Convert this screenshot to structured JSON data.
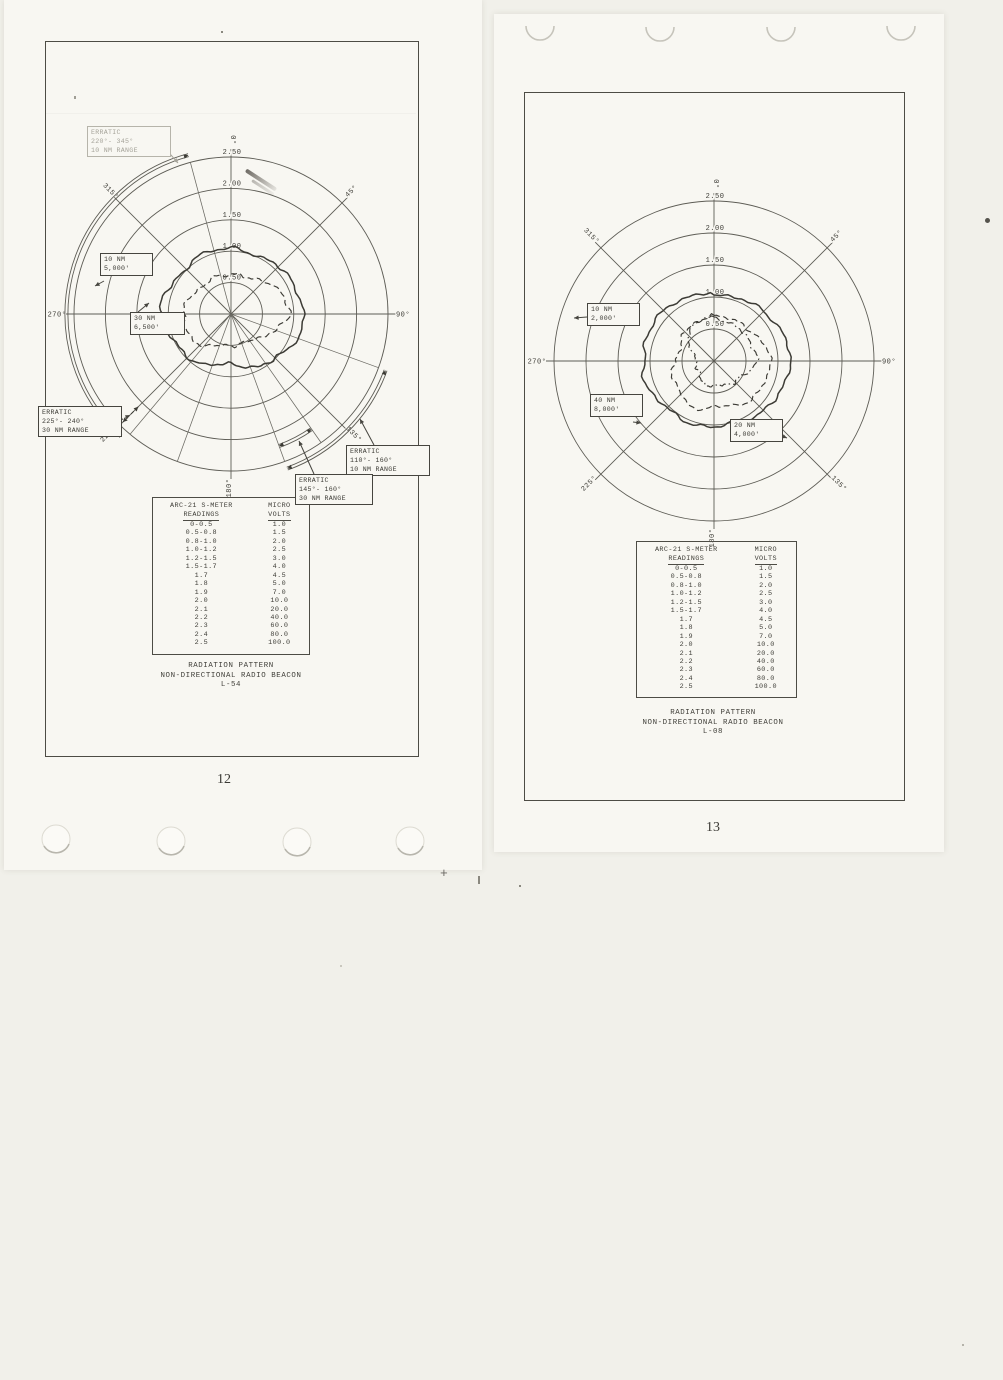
{
  "scan": {
    "backdrop_color": "#f1f0ea",
    "sheet_color": "#f8f7f2",
    "grid_color": "#5d5c55",
    "ink_color": "#3c3b35",
    "faded_color": "#a5a399"
  },
  "pages": [
    {
      "number": "12",
      "caption_lines": [
        "RADIATION PATTERN",
        "NON-DIRECTIONAL RADIO BEACON",
        "L-54"
      ]
    },
    {
      "number": "13",
      "caption_lines": [
        "RADIATION PATTERN",
        "NON-DIRECTIONAL RADIO BEACON",
        "L-08"
      ]
    }
  ],
  "smeter_table": {
    "col1_header": [
      "ARC-21 S-METER",
      "READINGS"
    ],
    "col2_header": [
      "MICRO",
      "VOLTS"
    ],
    "rows": [
      [
        "0-0.5",
        "1.0"
      ],
      [
        "0.5-0.8",
        "1.5"
      ],
      [
        "0.8-1.0",
        "2.0"
      ],
      [
        "1.0-1.2",
        "2.5"
      ],
      [
        "1.2-1.5",
        "3.0"
      ],
      [
        "1.5-1.7",
        "4.0"
      ],
      [
        "1.7",
        "4.5"
      ],
      [
        "1.8",
        "5.0"
      ],
      [
        "1.9",
        "7.0"
      ],
      [
        "2.0",
        "10.0"
      ],
      [
        "2.1",
        "20.0"
      ],
      [
        "2.2",
        "40.0"
      ],
      [
        "2.3",
        "60.0"
      ],
      [
        "2.4",
        "80.0"
      ],
      [
        "2.5",
        "100.0"
      ]
    ]
  },
  "chart_data": [
    {
      "type": "polar-radiation-pattern",
      "title": "RADIATION PATTERN NON-DIRECTIONAL RADIO BEACON L-54",
      "ring_labels": [
        "0.50",
        "1.00",
        "1.50",
        "2.00",
        "2.50"
      ],
      "angle_labels_deg": [
        0,
        45,
        90,
        135,
        180,
        225,
        270,
        315
      ],
      "extra_radials_deg": [
        110,
        145,
        160,
        200,
        220,
        345
      ],
      "layout": {
        "cx": 186,
        "cy": 273,
        "unit": 31.4,
        "rings": 5
      },
      "sectors": [
        {
          "from": 222,
          "to": 345,
          "r_px": 163
        },
        {
          "from": 110,
          "to": 160,
          "r_px": 163
        },
        {
          "from": 145,
          "to": 160,
          "r_px": 139
        }
      ],
      "radial_arrows": [
        {
          "deg": 225,
          "r1_px": 131,
          "r2_px": 153
        }
      ],
      "series": [
        {
          "name": "10 NM at 5,000 ft",
          "style": "solid",
          "seed": 3,
          "points": [
            [
              0,
              2.12
            ],
            [
              15,
              2.08
            ],
            [
              30,
              2.04
            ],
            [
              45,
              2.1
            ],
            [
              60,
              2.2
            ],
            [
              75,
              2.28
            ],
            [
              90,
              2.3
            ],
            [
              105,
              2.26
            ],
            [
              120,
              2.18
            ],
            [
              135,
              2.02
            ],
            [
              150,
              1.88
            ],
            [
              165,
              1.7
            ],
            [
              180,
              1.62
            ],
            [
              195,
              1.68
            ],
            [
              210,
              1.8
            ],
            [
              225,
              1.92
            ],
            [
              240,
              2.02
            ],
            [
              255,
              2.1
            ],
            [
              270,
              2.16
            ],
            [
              285,
              2.24
            ],
            [
              300,
              2.12
            ],
            [
              315,
              2.02
            ],
            [
              330,
              2.06
            ],
            [
              345,
              2.12
            ]
          ]
        },
        {
          "name": "30 NM at 6,500 ft",
          "style": "dashed",
          "seed": 8,
          "points": [
            [
              0,
              1.22
            ],
            [
              15,
              1.28
            ],
            [
              30,
              1.35
            ],
            [
              45,
              1.45
            ],
            [
              60,
              1.62
            ],
            [
              75,
              1.82
            ],
            [
              90,
              1.93
            ],
            [
              105,
              1.55
            ],
            [
              120,
              1.28
            ],
            [
              135,
              1.18
            ],
            [
              150,
              1.02
            ],
            [
              165,
              0.95
            ],
            [
              180,
              1.0
            ],
            [
              195,
              1.06
            ],
            [
              210,
              1.18
            ],
            [
              225,
              1.34
            ],
            [
              240,
              1.48
            ],
            [
              255,
              1.55
            ],
            [
              270,
              1.5
            ],
            [
              285,
              1.43
            ],
            [
              300,
              1.35
            ],
            [
              315,
              1.3
            ],
            [
              330,
              1.27
            ],
            [
              345,
              1.23
            ]
          ]
        }
      ],
      "callouts": [
        {
          "x": 87,
          "y": 126,
          "w": 76,
          "lines": [
            "ERRATIC",
            "220°- 345°",
            "10 NM RANGE"
          ],
          "anchor": [
            163,
            146
          ],
          "target": [
            178,
            163
          ],
          "faded": true
        },
        {
          "x": 100,
          "y": 253,
          "w": 45,
          "lines": [
            "10 NM",
            "5,000'"
          ],
          "anchor": [
            104,
            281
          ],
          "target": [
            95,
            286
          ]
        },
        {
          "x": 130,
          "y": 312,
          "w": 47,
          "lines": [
            "30 NM",
            "6,500'"
          ],
          "anchor": [
            138,
            312
          ],
          "target": [
            149,
            303
          ]
        },
        {
          "x": 38,
          "y": 406,
          "w": 76,
          "lines": [
            "ERRATIC",
            "225°- 240°",
            "30 NM RANGE"
          ],
          "anchor": [
            114,
            424
          ],
          "target": [
            130,
            415
          ],
          "dash": true
        },
        {
          "x": 346,
          "y": 445,
          "w": 76,
          "lines": [
            "ERRATIC",
            "110°- 160°",
            "10 NM RANGE"
          ],
          "anchor": [
            374,
            445
          ],
          "target": [
            360,
            419
          ]
        },
        {
          "x": 295,
          "y": 474,
          "w": 70,
          "lines": [
            "ERRATIC",
            "145°- 160°",
            "30 NM RANGE"
          ],
          "anchor": [
            314,
            474
          ],
          "target": [
            299,
            441
          ]
        }
      ]
    },
    {
      "type": "polar-radiation-pattern",
      "title": "RADIATION PATTERN NON-DIRECTIONAL RADIO BEACON L-08",
      "ring_labels": [
        "0.50",
        "1.00",
        "1.50",
        "2.00",
        "2.50"
      ],
      "angle_labels_deg": [
        0,
        45,
        90,
        135,
        180,
        225,
        270,
        315
      ],
      "extra_radials_deg": [],
      "layout": {
        "cx": 190,
        "cy": 269,
        "unit": 32,
        "rings": 5
      },
      "sectors": [],
      "radial_arrows": [],
      "series": [
        {
          "name": "10 NM at 2,000 ft",
          "style": "solid",
          "seed": 5,
          "points": [
            [
              0,
              2.12
            ],
            [
              15,
              2.05
            ],
            [
              30,
              2.1
            ],
            [
              45,
              2.22
            ],
            [
              60,
              2.3
            ],
            [
              75,
              2.32
            ],
            [
              90,
              2.35
            ],
            [
              105,
              2.38
            ],
            [
              120,
              2.28
            ],
            [
              135,
              2.15
            ],
            [
              150,
              2.08
            ],
            [
              165,
              2.05
            ],
            [
              180,
              2.08
            ],
            [
              195,
              2.02
            ],
            [
              210,
              2.08
            ],
            [
              225,
              2.1
            ],
            [
              240,
              2.18
            ],
            [
              255,
              2.22
            ],
            [
              270,
              2.18
            ],
            [
              285,
              2.28
            ],
            [
              300,
              2.22
            ],
            [
              315,
              2.18
            ],
            [
              330,
              2.2
            ],
            [
              345,
              2.18
            ]
          ]
        },
        {
          "name": "40 NM at 8,000 ft",
          "style": "dashed",
          "seed": 11,
          "points": [
            [
              0,
              1.45
            ],
            [
              15,
              1.4
            ],
            [
              30,
              1.38
            ],
            [
              45,
              1.45
            ],
            [
              60,
              1.58
            ],
            [
              75,
              1.68
            ],
            [
              90,
              1.72
            ],
            [
              105,
              1.78
            ],
            [
              120,
              1.72
            ],
            [
              135,
              1.65
            ],
            [
              150,
              1.55
            ],
            [
              165,
              1.48
            ],
            [
              180,
              1.45
            ],
            [
              195,
              1.52
            ],
            [
              210,
              1.58
            ],
            [
              225,
              1.48
            ],
            [
              240,
              1.42
            ],
            [
              255,
              1.32
            ],
            [
              270,
              1.2
            ],
            [
              285,
              1.15
            ],
            [
              300,
              1.18
            ],
            [
              315,
              1.25
            ],
            [
              330,
              1.32
            ],
            [
              345,
              1.4
            ]
          ]
        },
        {
          "name": "20 NM at 4,000 ft",
          "style": "dashdot",
          "seed": 17,
          "points": [
            [
              0,
              1.38
            ],
            [
              15,
              1.3
            ],
            [
              30,
              1.22
            ],
            [
              45,
              1.28
            ],
            [
              60,
              1.32
            ],
            [
              75,
              1.28
            ],
            [
              90,
              1.32
            ],
            [
              105,
              1.18
            ],
            [
              120,
              1.0
            ],
            [
              135,
              0.9
            ],
            [
              150,
              0.82
            ],
            [
              165,
              0.78
            ],
            [
              180,
              0.82
            ],
            [
              195,
              0.76
            ],
            [
              210,
              0.7
            ],
            [
              225,
              0.66
            ],
            [
              240,
              0.6
            ],
            [
              255,
              0.55
            ],
            [
              270,
              0.52
            ],
            [
              285,
              0.68
            ],
            [
              300,
              0.88
            ],
            [
              315,
              1.08
            ],
            [
              330,
              1.28
            ],
            [
              345,
              1.42
            ]
          ]
        }
      ],
      "callouts": [
        {
          "x": 587,
          "y": 303,
          "w": 45,
          "lines": [
            "10 NM",
            "2,000'"
          ],
          "anchor": [
            587,
            317
          ],
          "target": [
            574,
            318
          ]
        },
        {
          "x": 590,
          "y": 394,
          "w": 45,
          "lines": [
            "40 NM",
            "8,000'"
          ],
          "anchor": [
            633,
            422
          ],
          "target": [
            641,
            423
          ]
        },
        {
          "x": 730,
          "y": 419,
          "w": 45,
          "lines": [
            "20 NM",
            "4,000'"
          ],
          "anchor": [
            775,
            433
          ],
          "target": [
            787,
            438
          ]
        }
      ]
    }
  ],
  "scan_artifacts": {
    "binder_marks": [
      {
        "cx": 540,
        "cy": 26
      },
      {
        "cx": 660,
        "cy": 27
      },
      {
        "cx": 781,
        "cy": 27
      },
      {
        "cx": 901,
        "cy": 26
      }
    ],
    "punch_holes": [
      {
        "cx": 56,
        "cy": 839
      },
      {
        "cx": 171,
        "cy": 841
      },
      {
        "cx": 297,
        "cy": 842
      },
      {
        "cx": 410,
        "cy": 841
      }
    ],
    "plus_mark": "+",
    "specks": [
      {
        "x": 221,
        "y": 31,
        "w": 2,
        "h": 2,
        "c": "#8a887f"
      },
      {
        "x": 74,
        "y": 96,
        "w": 2,
        "h": 3,
        "c": "#a09e95"
      },
      {
        "x": 985,
        "y": 218,
        "w": 5,
        "h": 5,
        "c": "#55534c",
        "round": true
      },
      {
        "x": 478,
        "y": 876,
        "w": 1.5,
        "h": 8,
        "c": "#8a887f"
      },
      {
        "x": 519,
        "y": 885,
        "w": 2,
        "h": 2,
        "c": "#8a887f"
      },
      {
        "x": 340,
        "y": 965,
        "w": 2,
        "h": 2,
        "c": "#c9c7be"
      },
      {
        "x": 962,
        "y": 1344,
        "w": 2,
        "h": 2,
        "c": "#b5b3aa"
      }
    ]
  }
}
